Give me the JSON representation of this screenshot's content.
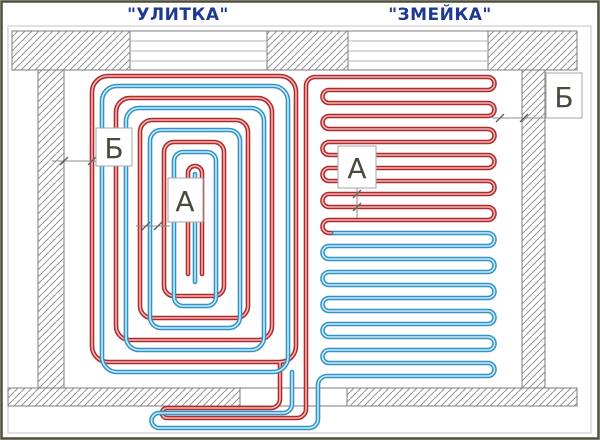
{
  "titles": {
    "left": "\"УЛИТКА\"",
    "right": "\"ЗМЕЙКА\""
  },
  "dim_labels": {
    "spiral_edge_gap": "Б",
    "spiral_pipe_step": "А",
    "serpentine_pipe_step": "А",
    "serpentine_edge_gap": "Б"
  },
  "colors": {
    "supply_pipe": "#b1282c",
    "supply_pipe_light": "#eab9b4",
    "return_pipe": "#2f94c5",
    "return_pipe_light": "#cdeaf7",
    "title_text": "#1d3a90",
    "label_text": "#4a4a3c",
    "wall_hatch": "#979797",
    "wall_outline": "#7d7d7d",
    "dimension": "#8c8c8c",
    "frame": "#4e4e38"
  }
}
